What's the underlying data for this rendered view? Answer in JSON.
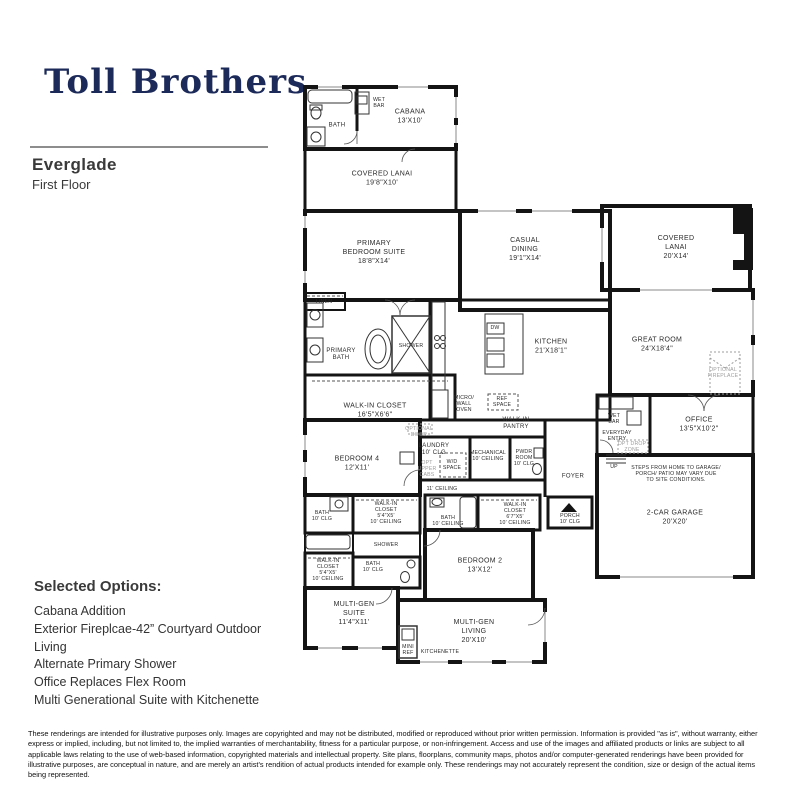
{
  "header": {
    "logo": "Toll Brothers",
    "plan_name": "Everglade",
    "floor": "First Floor"
  },
  "options": {
    "title": "Selected Options:",
    "items": [
      "Cabana Addition",
      "Exterior Fireplcae-42” Courtyard Outdoor Living",
      "Alternate Primary Shower",
      "Office Replaces Flex Room",
      "Multi Generational Suite with Kitchenette"
    ]
  },
  "disclaimer": "These renderings are intended for illustrative purposes only. Images are copyrighted and may not be distributed, modified or reproduced without prior written permission. Information is provided \"as is\", without warranty, either express or implied, including, but not limited to, the implied warranties of merchantability, fitness for a particular purpose, or non-infringement. Access and use of the images and affiliated products or links are subject to all applicable laws relating to the use of web-based information, copyrighted materials and intellectual property. Site plans, floorplans, community maps, photos and/or computer-generated renderings have been provided for illustrative purposes, are conceptual in nature, and are merely an artist's rendition of actual products intended for example only. These renderings may not accurately represent the condition, size or design of the actual items being represented.",
  "plan": {
    "labels": {
      "cabana_bath": "BATH",
      "cabana_wet_bar": "WET\nBAR",
      "cabana": "CABANA\n13'X10'",
      "covered_lanai_cabana": "COVERED LANAI\n19'8\"X10'",
      "primary_bedroom": "PRIMARY\nBEDROOM SUITE\n18'8\"X14'",
      "casual_dining": "CASUAL\nDINING\n19'1\"X14'",
      "covered_lanai_right": "COVERED\nLANAI\n20'X14'",
      "linen": "LINEN",
      "primary_bath": "PRIMARY\nBATH",
      "shower_primary": "SHOWER",
      "walkin_closet_primary": "WALK-IN CLOSET\n16'5\"X6'6\"",
      "kitchen": "KITCHEN\n21'X18'1\"",
      "dw": "DW",
      "great_room": "GREAT ROOM\n24'X18'4\"",
      "optional_fireplace": "OPTIONAL\nFIREPLACE",
      "micro_wall_oven": "MICRO/\nWALL\nOVEN",
      "ref_space": "REF\nSPACE",
      "walkin_pantry": "WALK-IN\nPANTRY",
      "optional_door": "OPTIONAL\nDOOR",
      "bedroom4": "BEDROOM 4\n12'X11'",
      "laundry": "LAUNDRY\n10' CLG",
      "opt_upper_cabs": "OPT\nUPPER\nCABS",
      "wd_space": "W/D\nSPACE",
      "mechanical": "MECHANICAL\n10' CEILING",
      "pwdr_room": "PWDR\nROOM\n10' CLG",
      "ceiling_11": "11' CEILING",
      "foyer": "FOYER",
      "wet_bar_garage": "WET\nBAR",
      "everyday_entry": "EVERYDAY\nENTRY",
      "opt_drop_zone": "OPT DROP\nZONE",
      "up": "UP",
      "office": "OFFICE\n13'5\"X10'2\"",
      "steps_note": "STEPS FROM HOME TO GARAGE/\nPORCH/ PATIO MAY VARY DUE\nTO SITE CONDITIONS.",
      "garage": "2-CAR GARAGE\n20'X20'",
      "bath4": "BATH\n10' CLG",
      "walkin_closet4": "WALK-IN\nCLOSET\n5'4\"X5'\n10' CEILING",
      "shower_mid": "SHOWER",
      "walkin_closet_mg": "WALK-IN\nCLOSET\n5'4\"X5'\n10' CEILING",
      "bath_mg": "BATH\n10' CLG",
      "multigen_suite": "MULTI-GEN\nSUITE\n11'4\"X11'",
      "bath2": "BATH\n10' CEILING",
      "walkin_closet2": "WALK-IN\nCLOSET\n6'7\"X5'\n10' CEILING",
      "porch": "PORCH\n10' CLG",
      "bedroom2": "BEDROOM 2\n13'X12'",
      "multigen_living": "MULTI-GEN\nLIVING\n20'X10'",
      "mini_ref": "MINI\nREF",
      "kitchenette": "KITCHENETTE"
    }
  }
}
